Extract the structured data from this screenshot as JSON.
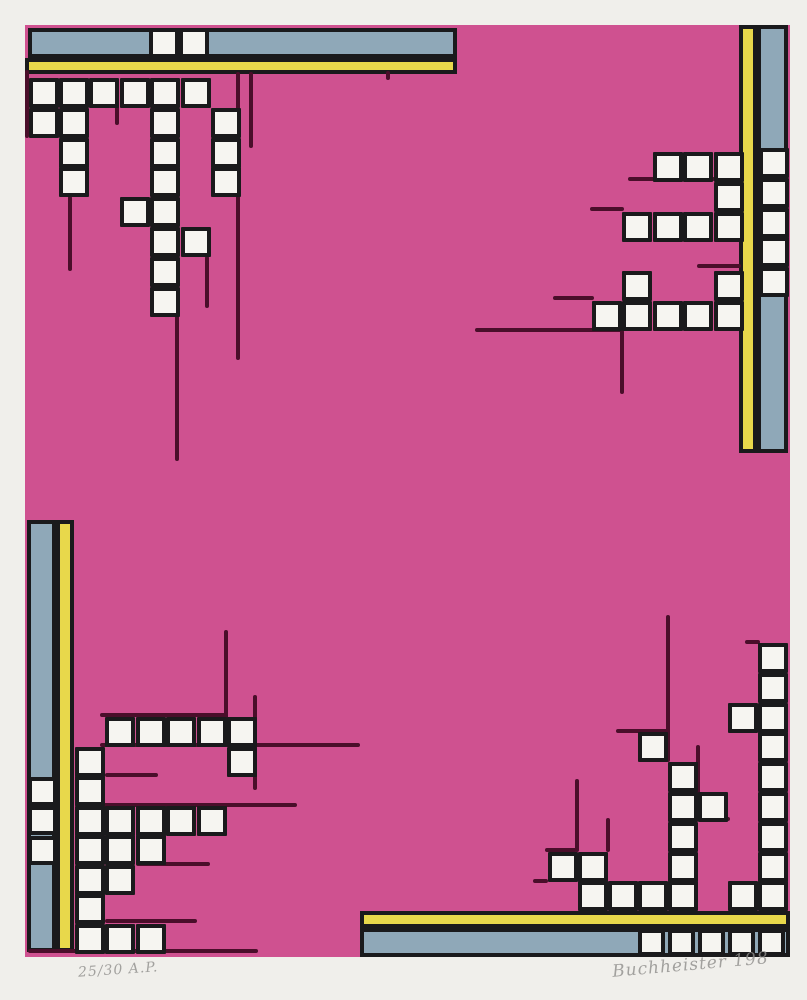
{
  "artwork": {
    "canvas": {
      "w": 807,
      "h": 1000
    },
    "colors": {
      "paper": "#f0efeb",
      "pink": "#cf5190",
      "blue": "#8fa8b8",
      "yellow": "#e8d84b",
      "black": "#1a1a1c",
      "line": "#4a0e2a",
      "square_white": "#f6f5f1",
      "pencil_gray": "#8f8e8c"
    },
    "field": {
      "x": 25,
      "y": 25,
      "w": 765,
      "h": 932
    },
    "bars": [
      {
        "name": "top-blue-bar",
        "x": 28,
        "y": 28,
        "w": 429,
        "h": 30,
        "color": "blue"
      },
      {
        "name": "top-yellow-bar",
        "x": 25,
        "y": 58,
        "w": 432,
        "h": 16,
        "color": "yellow"
      },
      {
        "name": "right-yellow-bar",
        "x": 739,
        "y": 25,
        "w": 18,
        "h": 428,
        "color": "yellow"
      },
      {
        "name": "right-blue-bar",
        "x": 757,
        "y": 25,
        "w": 31,
        "h": 428,
        "color": "blue"
      },
      {
        "name": "left-blue-bar",
        "x": 27,
        "y": 520,
        "w": 29,
        "h": 432,
        "color": "blue"
      },
      {
        "name": "left-yellow-bar",
        "x": 56,
        "y": 520,
        "w": 18,
        "h": 432,
        "color": "yellow"
      },
      {
        "name": "bottom-yellow-bar",
        "x": 360,
        "y": 911,
        "w": 430,
        "h": 17,
        "color": "yellow"
      },
      {
        "name": "bottom-blue-bar",
        "x": 360,
        "y": 928,
        "w": 430,
        "h": 29,
        "color": "blue"
      }
    ],
    "clusters": [
      {
        "name": "top-left-cluster",
        "origin": [
          28.5,
          78
        ],
        "pitch": [
          30.4,
          29.8
        ],
        "size": 30,
        "cells": [
          [
            0,
            0
          ],
          [
            1,
            0
          ],
          [
            2,
            0
          ],
          [
            3,
            0
          ],
          [
            4,
            0
          ],
          [
            5,
            0
          ],
          [
            0,
            1
          ],
          [
            1,
            1
          ],
          [
            4,
            1
          ],
          [
            6,
            1
          ],
          [
            1,
            2
          ],
          [
            4,
            2
          ],
          [
            6,
            2
          ],
          [
            1,
            3
          ],
          [
            4,
            3
          ],
          [
            6,
            3
          ],
          [
            3,
            4
          ],
          [
            4,
            4
          ],
          [
            4,
            5
          ],
          [
            5,
            5
          ],
          [
            4,
            6
          ],
          [
            4,
            7
          ]
        ]
      },
      {
        "name": "top-right-cluster",
        "origin": [
          592,
          152
        ],
        "pitch": [
          30.4,
          29.8
        ],
        "size": 30,
        "cells": [
          [
            2,
            0
          ],
          [
            3,
            0
          ],
          [
            4,
            0
          ],
          [
            4,
            1
          ],
          [
            1,
            2
          ],
          [
            2,
            2
          ],
          [
            3,
            2
          ],
          [
            4,
            2
          ],
          [
            1,
            4
          ],
          [
            4,
            4
          ],
          [
            0,
            5
          ],
          [
            1,
            5
          ],
          [
            2,
            5
          ],
          [
            3,
            5
          ],
          [
            4,
            5
          ]
        ]
      },
      {
        "name": "right-bar-squares",
        "origin": [
          759,
          148
        ],
        "pitch": [
          30.4,
          29.8
        ],
        "size": 30,
        "cells": [
          [
            0,
            0
          ],
          [
            0,
            1
          ],
          [
            0,
            2
          ],
          [
            0,
            3
          ],
          [
            0,
            4
          ]
        ]
      },
      {
        "name": "top-bar-squares",
        "origin": [
          149,
          28
        ],
        "pitch": [
          30.4,
          29.8
        ],
        "size": 30,
        "cells": [
          [
            0,
            0
          ],
          [
            1,
            0
          ]
        ]
      },
      {
        "name": "bottom-left-cluster",
        "origin": [
          75,
          717
        ],
        "pitch": [
          30.4,
          29.5
        ],
        "size": 30,
        "cells": [
          [
            1,
            0
          ],
          [
            2,
            0
          ],
          [
            3,
            0
          ],
          [
            4,
            0
          ],
          [
            5,
            0
          ],
          [
            0,
            1
          ],
          [
            5,
            1
          ],
          [
            0,
            2
          ],
          [
            0,
            3
          ],
          [
            1,
            3
          ],
          [
            2,
            3
          ],
          [
            3,
            3
          ],
          [
            4,
            3
          ],
          [
            0,
            4
          ],
          [
            1,
            4
          ],
          [
            2,
            4
          ],
          [
            0,
            5
          ],
          [
            1,
            5
          ],
          [
            0,
            6
          ],
          [
            0,
            7
          ],
          [
            1,
            7
          ],
          [
            2,
            7
          ]
        ]
      },
      {
        "name": "left-bar-squares",
        "origin": [
          27.5,
          776.5
        ],
        "pitch": [
          30.4,
          29.5
        ],
        "size": 29,
        "cells": [
          [
            0,
            0
          ],
          [
            0,
            1
          ],
          [
            0,
            2
          ]
        ]
      },
      {
        "name": "bottom-right-cluster",
        "origin": [
          547.5,
          643
        ],
        "pitch": [
          30.1,
          29.8
        ],
        "size": 30,
        "cells": [
          [
            7,
            0
          ],
          [
            7,
            1
          ],
          [
            7,
            2
          ],
          [
            7,
            3
          ],
          [
            7,
            4
          ],
          [
            7,
            5
          ],
          [
            7,
            6
          ],
          [
            7,
            7
          ],
          [
            7,
            8
          ],
          [
            6,
            2
          ],
          [
            6,
            8
          ],
          [
            5,
            5
          ],
          [
            4,
            4
          ],
          [
            4,
            5
          ],
          [
            4,
            6
          ],
          [
            4,
            7
          ],
          [
            4,
            8
          ],
          [
            3,
            3
          ],
          [
            3,
            8
          ],
          [
            2,
            8
          ],
          [
            1,
            7
          ],
          [
            1,
            8
          ],
          [
            0,
            7
          ]
        ]
      },
      {
        "name": "bottom-bar-squares",
        "origin": [
          637.8,
          929
        ],
        "pitch": [
          30.1,
          29.8
        ],
        "size": 27,
        "cells": [
          [
            0,
            0
          ],
          [
            1,
            0
          ],
          [
            2,
            0
          ],
          [
            3,
            0
          ],
          [
            4,
            0
          ]
        ]
      }
    ],
    "lines": [
      [
        27,
        70,
        27,
        138
      ],
      [
        117,
        104,
        117,
        125
      ],
      [
        70,
        196,
        70,
        271
      ],
      [
        177,
        314,
        177,
        461
      ],
      [
        207,
        256,
        207,
        308
      ],
      [
        238,
        72,
        238,
        360
      ],
      [
        251,
        72,
        251,
        148
      ],
      [
        388,
        71,
        388,
        80
      ],
      [
        628,
        179,
        715,
        179
      ],
      [
        590,
        209,
        624,
        209
      ],
      [
        697,
        266,
        741,
        266
      ],
      [
        553,
        298,
        594,
        298
      ],
      [
        475,
        330,
        624,
        330
      ],
      [
        622,
        330,
        622,
        394
      ],
      [
        226,
        630,
        226,
        719
      ],
      [
        100,
        715,
        226,
        715
      ],
      [
        255,
        695,
        255,
        790
      ],
      [
        100,
        745,
        360,
        745
      ],
      [
        105,
        775,
        158,
        775
      ],
      [
        75,
        805,
        297,
        805
      ],
      [
        136,
        864,
        210,
        864
      ],
      [
        105,
        921,
        197,
        921
      ],
      [
        28,
        951,
        258,
        951
      ],
      [
        668,
        615,
        668,
        762
      ],
      [
        616,
        731,
        668,
        731
      ],
      [
        698,
        745,
        698,
        798
      ],
      [
        745,
        642,
        760,
        642
      ],
      [
        700,
        819,
        730,
        819
      ],
      [
        577,
        779,
        577,
        852
      ],
      [
        608,
        818,
        608,
        852
      ],
      [
        545,
        850,
        577,
        850
      ],
      [
        533,
        881,
        548,
        881
      ]
    ],
    "inscriptions": {
      "edition": "25/30 A.P.",
      "signature": "Buchheister 198"
    }
  }
}
